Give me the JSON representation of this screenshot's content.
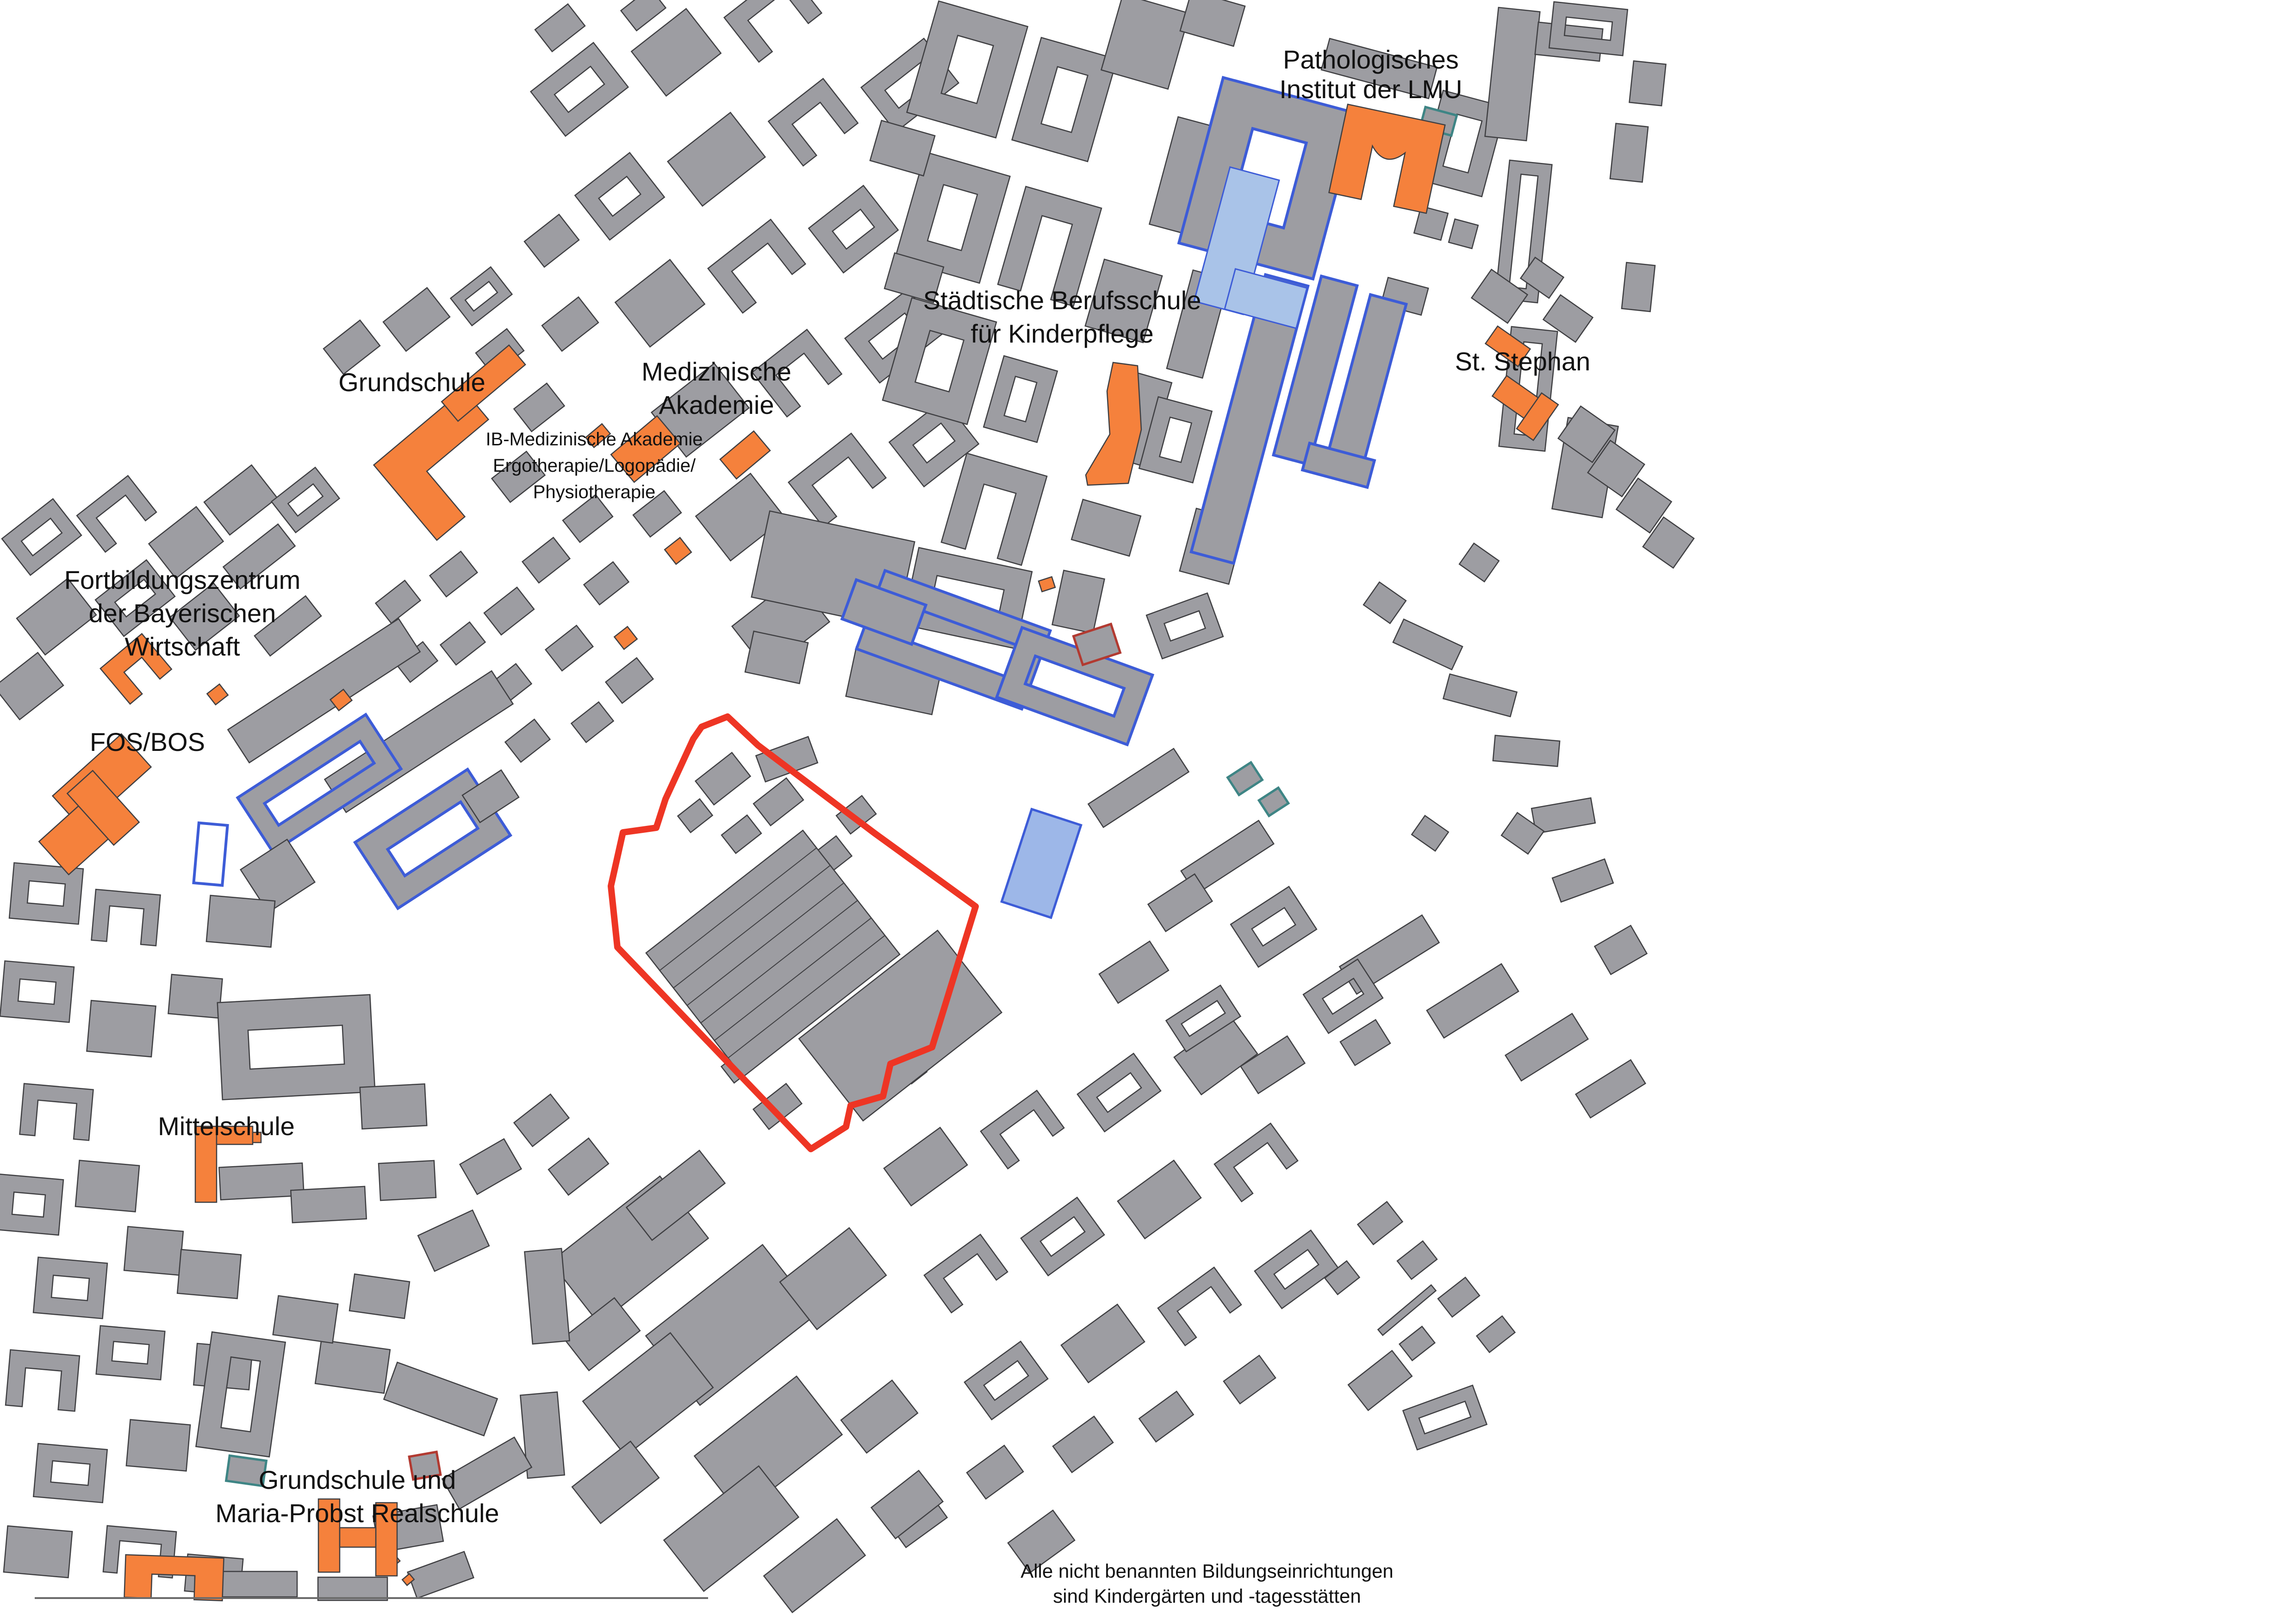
{
  "map": {
    "background": "#ffffff",
    "colors": {
      "building_fill": "#9d9da2",
      "building_outline": "#3f3f42",
      "education_highlight": "#F5813C",
      "site_boundary_red": "#EE3524",
      "blue_outline": "#3D5CD7",
      "light_blue_fill": "#A9C3E8",
      "hatch_blue_fill": "#9DB7E8",
      "teal_outline": "#3E8585",
      "dark_red_outline": "#B23A31",
      "frame_line": "#6b6b6b",
      "label_text": "#111111"
    },
    "labels": [
      {
        "id": "pathologisches-institut-der-lmu",
        "lines": [
          "Pathologisches",
          "Institut der LMU"
        ]
      },
      {
        "id": "staedtische-berufsschule",
        "lines": [
          "Städtische Berufsschule",
          "für Kinderpflege"
        ]
      },
      {
        "id": "st-stephan",
        "lines": [
          "St. Stephan"
        ]
      },
      {
        "id": "grundschule",
        "lines": [
          "Grundschule"
        ]
      },
      {
        "id": "medizinische-akademie",
        "lines": [
          "Medizinische",
          "Akademie"
        ]
      },
      {
        "id": "ib-medizinische-akademie",
        "lines": [
          "IB-Medizinische Akademie",
          "Ergotherapie/Logopädie/",
          "Physiotherapie"
        ]
      },
      {
        "id": "fortbildungszentrum",
        "lines": [
          "Fortbildungszentrum",
          "der Bayerischen",
          "Wirtschaft"
        ]
      },
      {
        "id": "fos-bos",
        "lines": [
          "FOS/BOS"
        ]
      },
      {
        "id": "mittelschule",
        "lines": [
          "Mittelschule"
        ]
      },
      {
        "id": "grundschule-maria-probst",
        "lines": [
          "Grundschule und",
          "Maria-Probst Realschule"
        ]
      }
    ],
    "annotation": {
      "lines": [
        "Alle nicht benannten Bildungseinrichtungen",
        "sind Kindergärten und -tagesstätten"
      ]
    }
  }
}
